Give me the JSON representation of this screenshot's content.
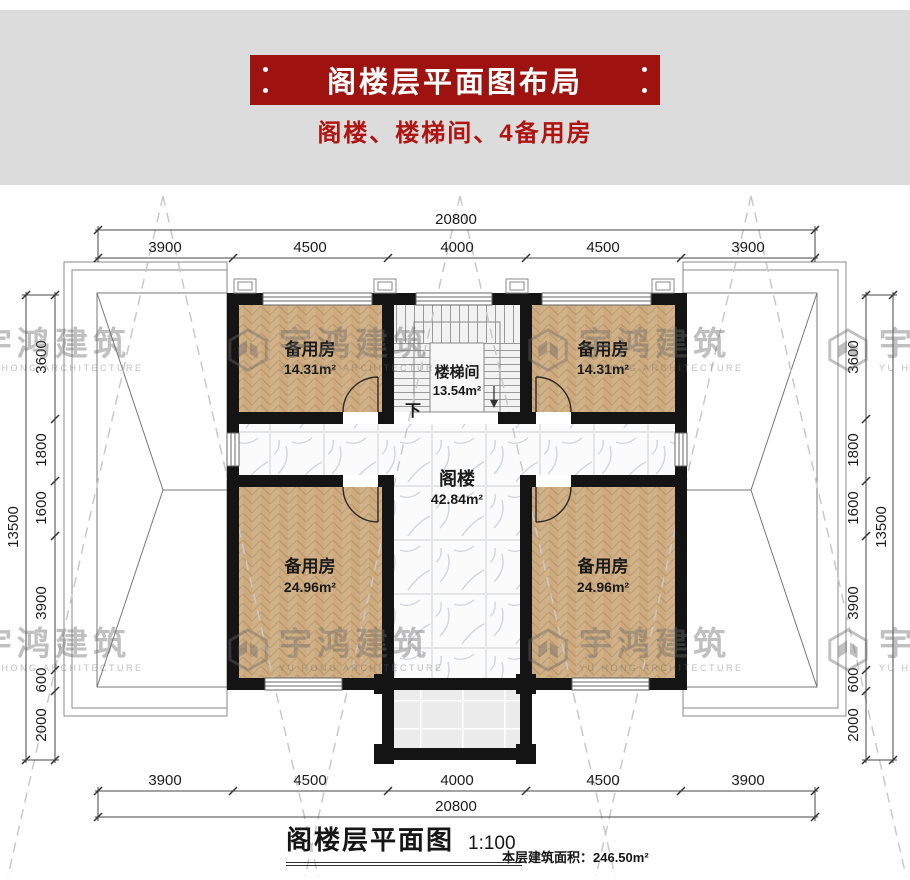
{
  "header": {
    "title": "阁楼层平面图布局",
    "subtitle": "阁楼、楼梯间、4备用房"
  },
  "watermark": {
    "name": "宇鸿建筑",
    "tagline": "YU HONG ARCHITECTURE"
  },
  "plan": {
    "rooms": {
      "spare_top_left": {
        "name": "备用房",
        "area": "14.31m²"
      },
      "spare_top_right": {
        "name": "备用房",
        "area": "14.31m²"
      },
      "spare_bottom_left": {
        "name": "备用房",
        "area": "24.96m²"
      },
      "spare_bottom_right": {
        "name": "备用房",
        "area": "24.96m²"
      },
      "stairwell": {
        "name": "楼梯间",
        "area": "13.54m²"
      },
      "attic": {
        "name": "阁楼",
        "area": "42.84m²"
      }
    },
    "stair_down_label": "下",
    "dimensions": {
      "horizontal_total": "20800",
      "horizontal_segments": [
        "3900",
        "4500",
        "4000",
        "4500",
        "3900"
      ],
      "vertical_total": "13500",
      "vertical_segments": [
        "3600",
        "1800",
        "1600",
        "3900",
        "600",
        "2000"
      ]
    }
  },
  "footer": {
    "title": "阁楼层平面图",
    "scale": "1:100",
    "area_note": "本层建筑面积：246.50m²"
  },
  "colors": {
    "banner_red": "#9e1310",
    "subtitle_red": "#ae1511",
    "wall_black": "#141414",
    "wood": "#cdab7e",
    "band_gray": "#dcdcdc"
  }
}
